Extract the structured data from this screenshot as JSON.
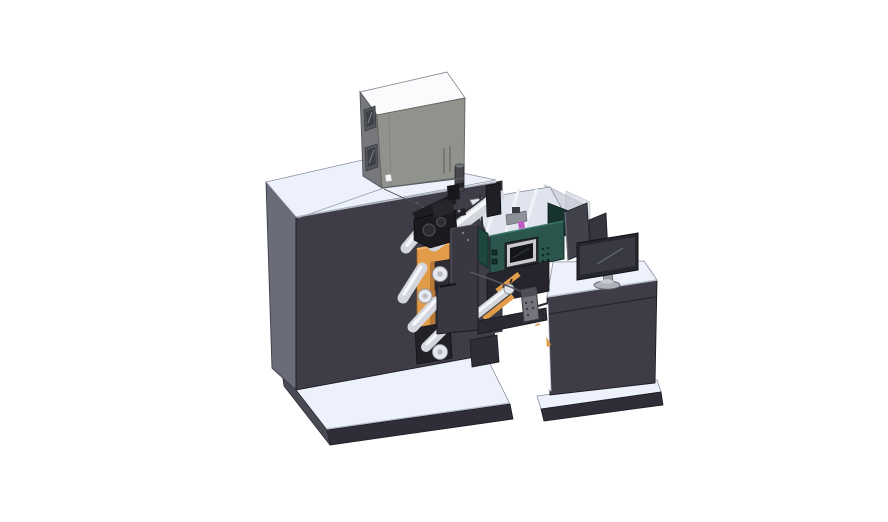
{
  "scene": {
    "title": "3D CAD render of a roll-fed label printing machine with electrical cabinet, web rollers, HMI control panel and operator desk with monitor",
    "background": "#ffffff"
  },
  "colors": {
    "surface_top": "#ecf1fb",
    "body_front": "#3e3d47",
    "body_side": "#6a6c7a",
    "edge_dark": "#2f2e38",
    "box_top": "#fafbfc",
    "box_front": "#90928e",
    "box_side": "#76787c",
    "accent_orange": "#e29c49",
    "orange_shade": "#b87a36",
    "orange_highlight": "#f4b468",
    "teal_face": "#2a564e",
    "teal_dark": "#1d4840",
    "roller": "#d3d6dd",
    "roller_highlight": "#f5f7fa",
    "black_parts": "#1a1a1f",
    "panel_dark": "#393841",
    "monitor_bezel": "#26262d",
    "monitor_screen": "#383942",
    "divider": "#42424c",
    "pendant": "#74747c",
    "magenta": "#c05ac2",
    "deck_floor": "#dfe4ee",
    "glass": "#c6ccd8",
    "white_detail": "#f2f3f5",
    "screen_black": "#15161b",
    "display_frame": "#c8cacf"
  },
  "components": [
    {
      "id": "base-platform",
      "label": "machine base platform"
    },
    {
      "id": "machine-body",
      "label": "main machine body"
    },
    {
      "id": "electrical-cabinet",
      "label": "electrical cabinet on top"
    },
    {
      "id": "unwind-station",
      "label": "orange unwind station side plate"
    },
    {
      "id": "web-rollers",
      "label": "white web guide rollers"
    },
    {
      "id": "print-head-assembly",
      "label": "black print head assembly"
    },
    {
      "id": "front-guard-panel",
      "label": "front guard panel"
    },
    {
      "id": "process-deck",
      "label": "open process deck with rails"
    },
    {
      "id": "hmi-control-panel",
      "label": "teal HMI control panel with display"
    },
    {
      "id": "pendant-remote",
      "label": "hanging pendant remote"
    },
    {
      "id": "transfer-beam",
      "label": "web transfer beam"
    },
    {
      "id": "operator-desk",
      "label": "operator desk cabinet"
    },
    {
      "id": "privacy-panels",
      "label": "divider panels"
    },
    {
      "id": "monitor",
      "label": "desktop monitor"
    }
  ]
}
